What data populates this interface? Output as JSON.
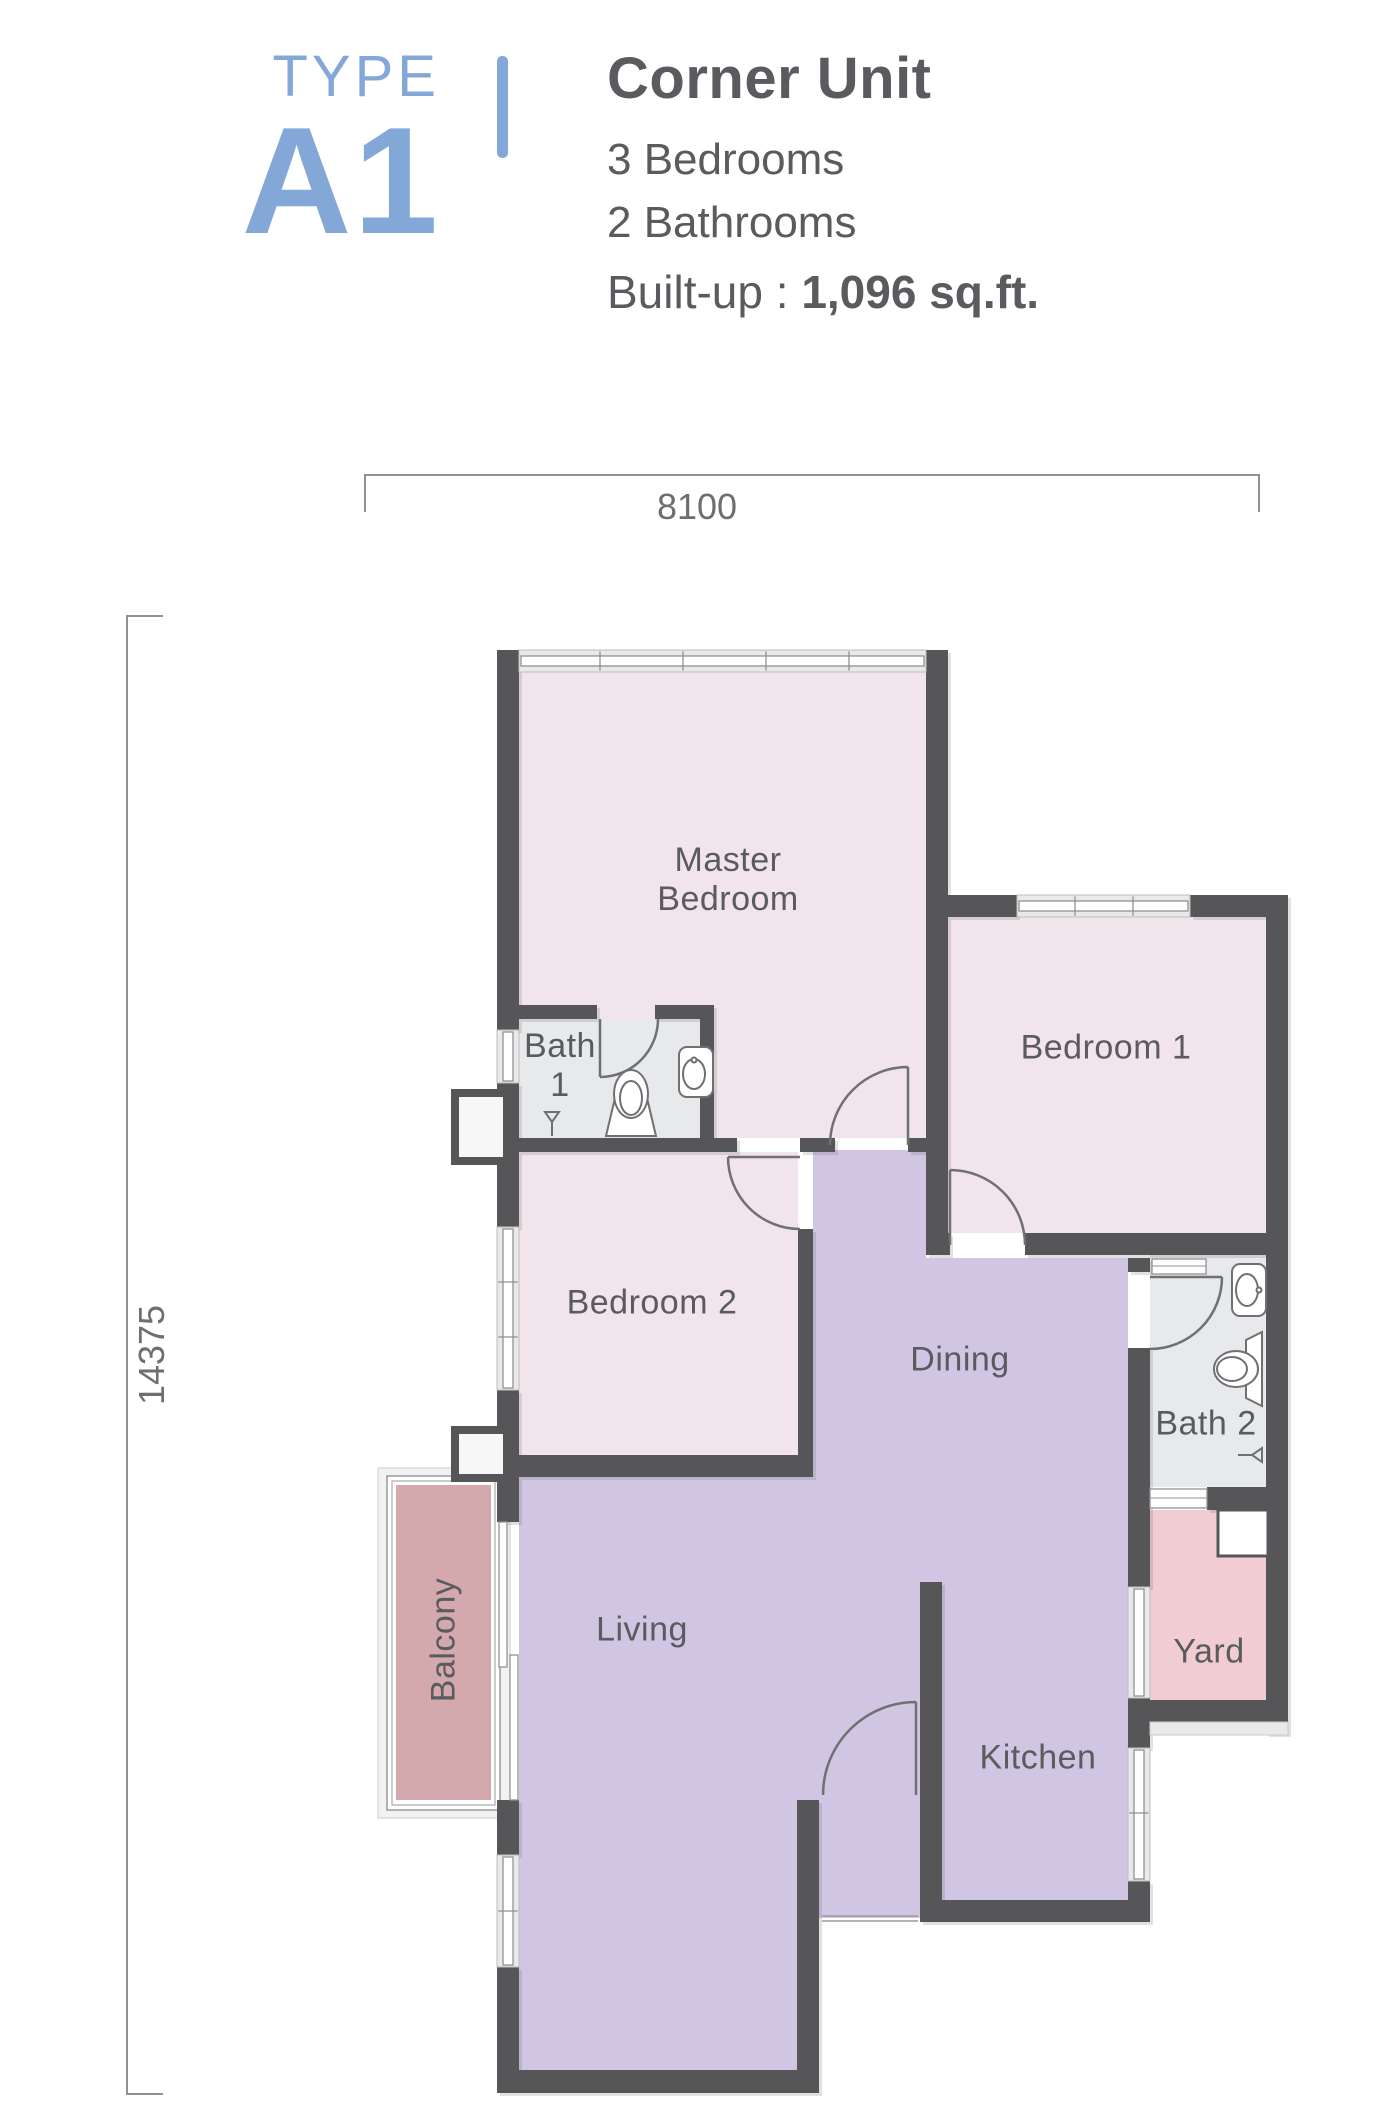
{
  "header": {
    "type_label": "TYPE",
    "unit_code": "A1",
    "unit_name": "Corner Unit",
    "bedrooms": "3 Bedrooms",
    "bathrooms": "2 Bathrooms",
    "builtup_label": "Built-up : ",
    "builtup_value": "1,096 sq.ft."
  },
  "dimensions": {
    "width": "8100",
    "height": "14375"
  },
  "rooms": {
    "master_bedroom": "Master Bedroom",
    "bedroom1": "Bedroom 1",
    "bedroom2": "Bedroom 2",
    "bath1": "Bath 1",
    "bath2": "Bath 2",
    "dining": "Dining",
    "living": "Living",
    "kitchen": "Kitchen",
    "balcony": "Balcony",
    "yard": "Yard"
  },
  "colors": {
    "accent": "#83a8d7",
    "wall": "#565659",
    "bedroom-fill": "#f1e4ea",
    "living-fill": "#d0c5e2",
    "bath-fill": "#e8e9ea",
    "balcony-fill": "#d4a9ae",
    "yard-fill": "#f1cdd3",
    "window-band": "#e9e9e9",
    "window-pane": "#ffffff",
    "door-stroke": "#6f7073",
    "fixture-stroke": "#6f7073",
    "label-text": "#5a5b5e",
    "dimension-line": "#8f9194",
    "dimension-text": "#6d6e71"
  }
}
